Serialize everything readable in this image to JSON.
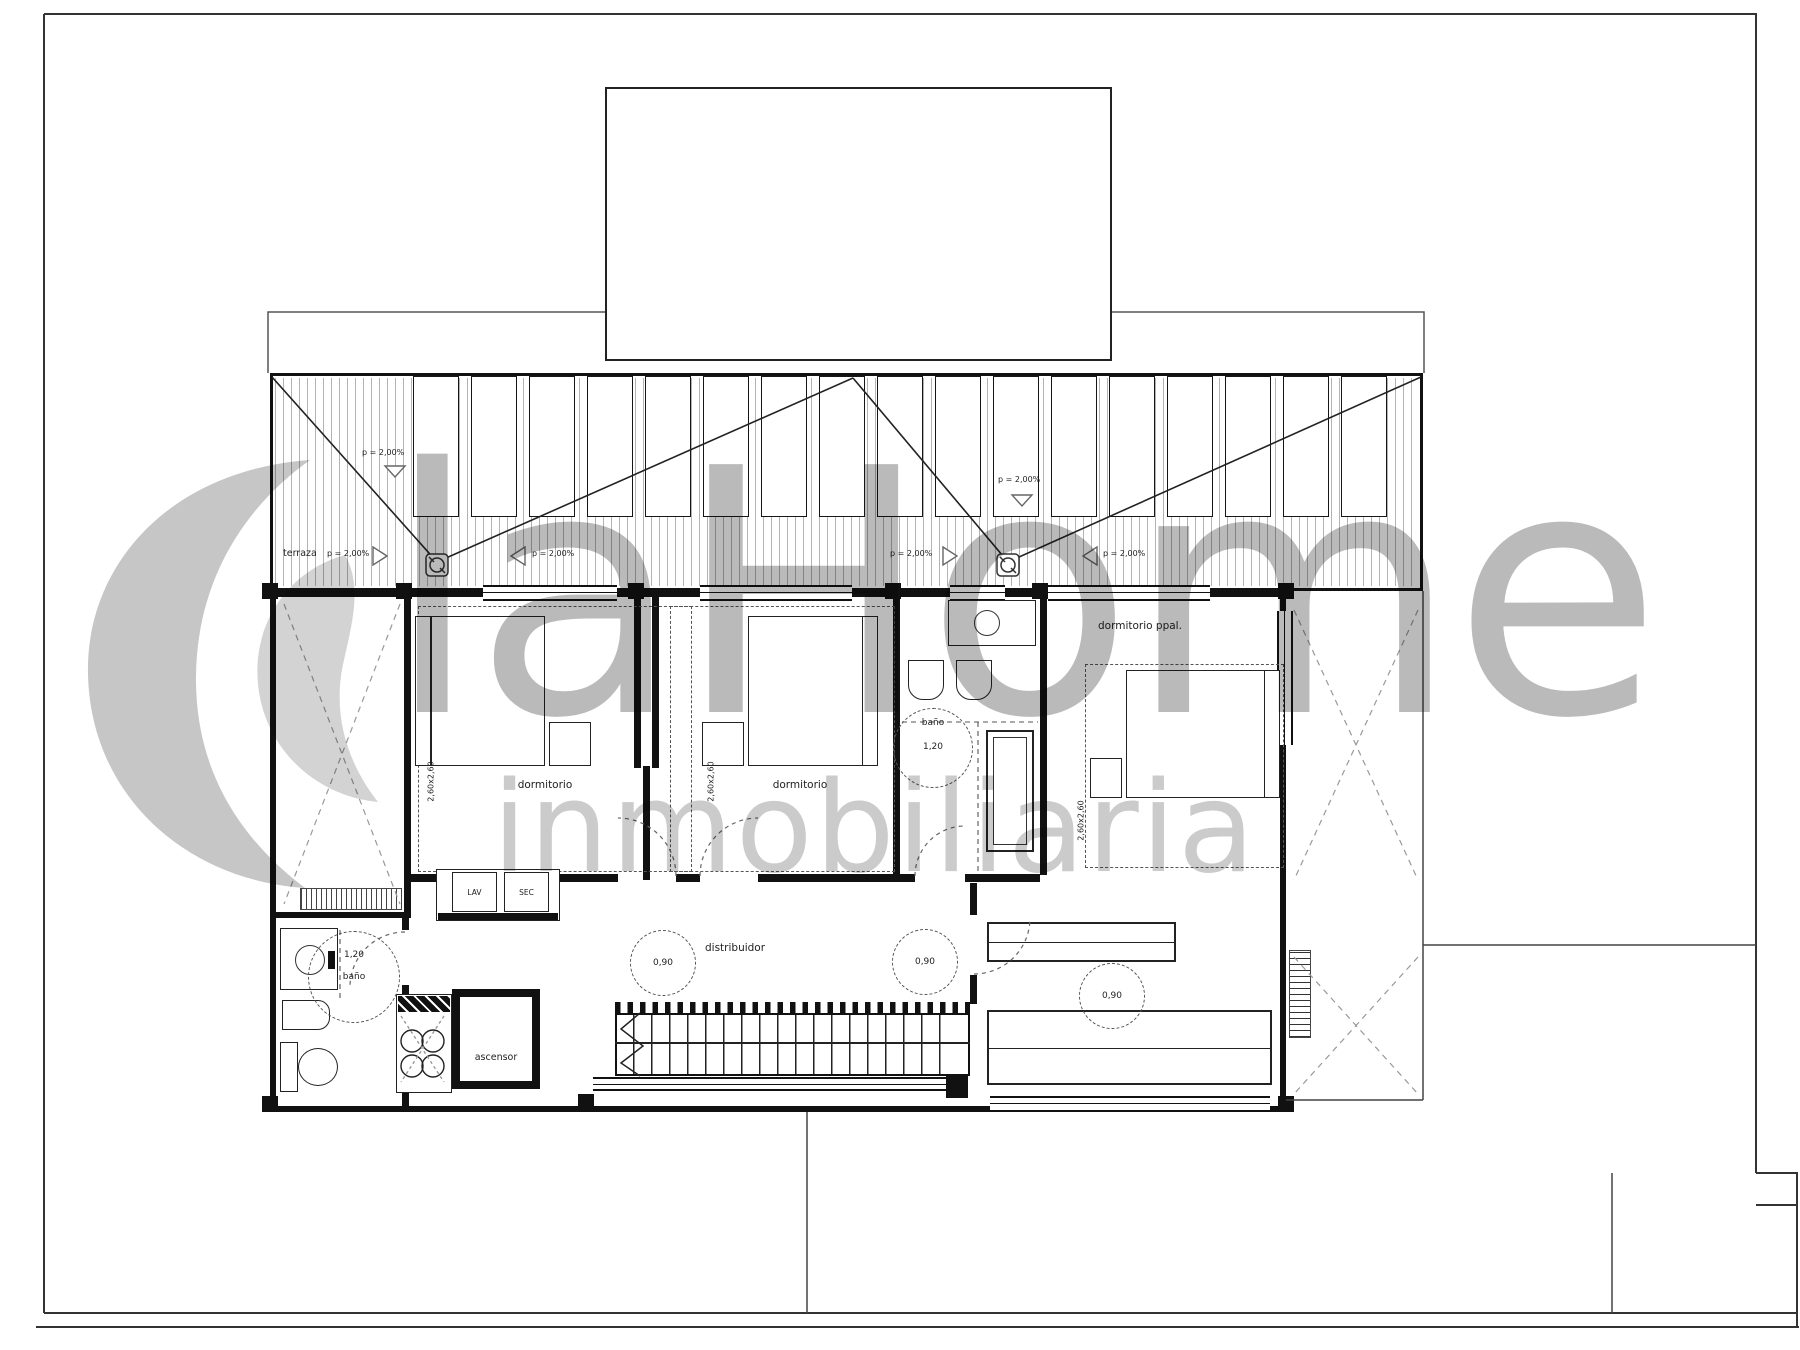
{
  "watermark": {
    "brand": "laHome",
    "subtitle": "inmobiliaria"
  },
  "terrace": {
    "label": "terraza",
    "slope": "p = 2,00%"
  },
  "rooms": {
    "bedroom1": {
      "label": "dormitorio",
      "dim": "2,60x2,60"
    },
    "bedroom2": {
      "label": "dormitorio",
      "dim": "2,60x2,60"
    },
    "master": {
      "label": "dormitorio ppal.",
      "dim": "2,60x2,60"
    },
    "bath1": {
      "label": "baño",
      "clearance": "1,20"
    },
    "bath2": {
      "label": "baño",
      "clearance": "1,20"
    },
    "hall": {
      "label": "distribuidor",
      "clearance": "0,90"
    },
    "dressing": {
      "clearance": "0,90"
    },
    "elevator": {
      "label": "ascensor"
    },
    "laundry": {
      "washer": "LAV",
      "dryer": "SEC"
    }
  },
  "colors": {
    "line": "#111111",
    "hatch": "#999999",
    "watermark_text": "#a0a0a0",
    "watermark_sub": "#b7b7b7"
  }
}
